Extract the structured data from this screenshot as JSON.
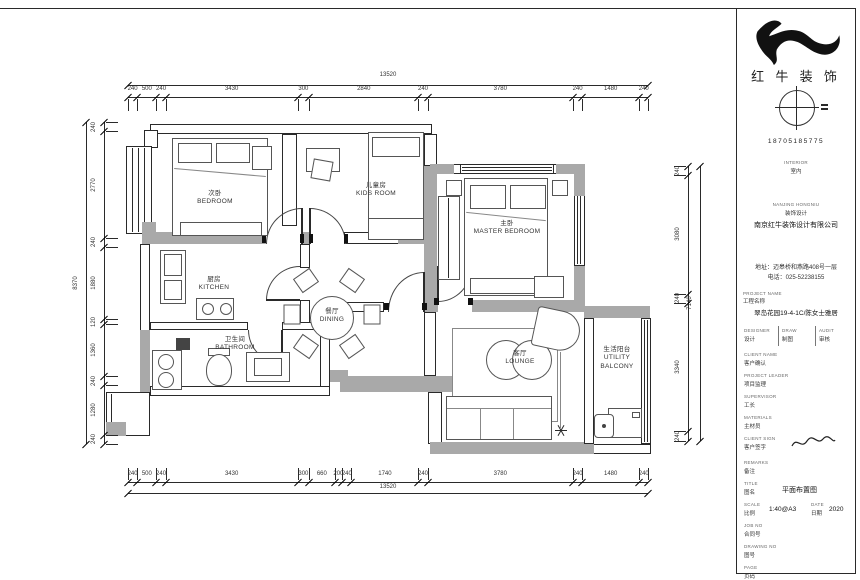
{
  "document": {
    "type": "residential-floor-plan",
    "brand_name": "红 牛 装 饰",
    "phone": "18705185775"
  },
  "rooms": [
    {
      "id": "bedroom",
      "cn": "次卧",
      "en": "BEDROOM"
    },
    {
      "id": "kids-room",
      "cn": "儿童房",
      "en": "KIDS ROOM"
    },
    {
      "id": "master-bedroom",
      "cn": "主卧",
      "en": "MASTER BEDROOM"
    },
    {
      "id": "kitchen",
      "cn": "厨房",
      "en": "KITCHEN"
    },
    {
      "id": "dining",
      "cn": "餐厅",
      "en": "DINING"
    },
    {
      "id": "bathroom",
      "cn": "卫生间",
      "en": "BATHROOM"
    },
    {
      "id": "lounge",
      "cn": "客厅",
      "en": "LOUNGE"
    },
    {
      "id": "utility-balcony",
      "cn": "生活阳台",
      "en": "UTILITY BALCONY"
    }
  ],
  "dimensions": {
    "unit": "mm",
    "top": {
      "total": 13520,
      "segments": [
        240,
        500,
        240,
        3430,
        300,
        2840,
        240,
        3780,
        240,
        1480,
        240
      ]
    },
    "bottom": {
      "total": 13520,
      "segments": [
        240,
        500,
        240,
        3430,
        300,
        660,
        200,
        240,
        1740,
        240,
        3780,
        240,
        1480,
        240
      ]
    },
    "left": {
      "total": 8370,
      "segments": [
        240,
        2770,
        240,
        1880,
        120,
        1360,
        240,
        1280,
        240
      ]
    },
    "right": {
      "total": 7140,
      "segments": [
        240,
        3080,
        240,
        3340,
        240
      ]
    }
  },
  "title_block": {
    "logo": "bull-icon",
    "brand_name": "红 牛 装 饰",
    "compass": "compass-icon",
    "phone": "18705185775",
    "dept": {
      "en": "INTERIOR",
      "cn": "室内"
    },
    "firm": {
      "en_small": "NANJING HONGNIU",
      "cn_small": "装饰设计",
      "name": "南京红牛装饰设计有限公司"
    },
    "contact": {
      "address": "地址：迈皋桥和燕路408号一层",
      "tel": "电话：025-52238155"
    },
    "project": {
      "label_en": "PROJECT NAME",
      "label_cn": "工程名称",
      "value": "翠岛花园19-4-1C/陈女士雅居"
    },
    "cols3": [
      {
        "en": "DESIGNER",
        "cn": "设计"
      },
      {
        "en": "DRAW",
        "cn": "制图"
      },
      {
        "en": "AUDIT",
        "cn": "审核"
      }
    ],
    "rows": [
      {
        "en": "CLIENT NAME",
        "cn": "客户确认"
      },
      {
        "en": "PROJECT LEADER",
        "cn": "项目监理"
      },
      {
        "en": "SUPERVISOR",
        "cn": "工长"
      },
      {
        "en": "MATERIALS",
        "cn": "主材员"
      },
      {
        "en": "CLIENT SIGN",
        "cn": "客户签字"
      },
      {
        "en": "REMARKS",
        "cn": "备注"
      },
      {
        "en": "UNIT",
        "cn": "施工单位"
      }
    ],
    "bottom": {
      "title": {
        "en": "TITLE",
        "cn": "图名",
        "value": "平面布置图"
      },
      "scale": {
        "en": "SCALE",
        "cn": "比例",
        "value": "1:40@A3"
      },
      "date": {
        "en": "DATE",
        "cn": "日期",
        "value": "2020"
      },
      "job": {
        "en": "JOB NO",
        "cn": "合同号",
        "value": ""
      },
      "drawno": {
        "en": "DRAWING NO",
        "cn": "图号",
        "value": ""
      },
      "page": {
        "en": "PAGE",
        "cn": "页码",
        "value": ""
      }
    }
  }
}
